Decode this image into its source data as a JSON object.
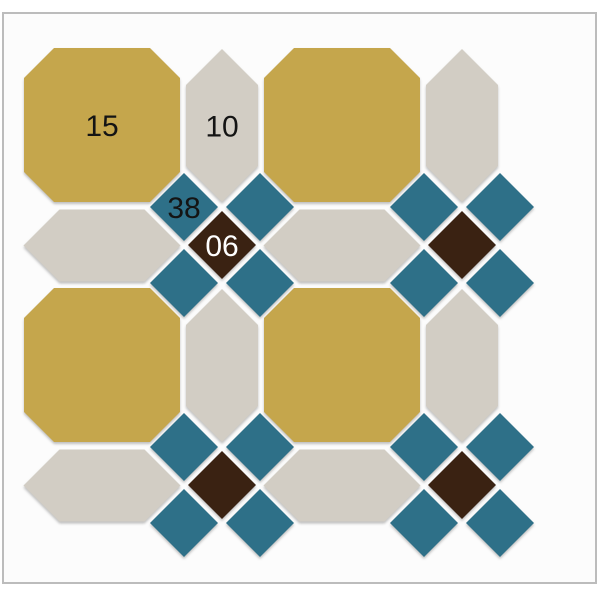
{
  "canvas": {
    "width": 600,
    "height": 600,
    "frame": {
      "x": 3,
      "y": 13,
      "w": 593,
      "h": 570
    }
  },
  "palette": {
    "octagon_fill": "#C5A64C",
    "picket_fill": "#D2CDC4",
    "square_fill": "#2E7088",
    "dot_fill": "#3A2212",
    "label_dark": "#141414",
    "label_light": "#FFFFFF",
    "panel_fill": "#FCFCFC",
    "panel_border": "#BCBCBC",
    "page_bg": "#FFFFFF"
  },
  "legend": {
    "octagon_code": "15",
    "picket_code": "10",
    "square_code": "38",
    "dot_code": "06"
  },
  "pattern": {
    "unit": 240,
    "octagon_shape": {
      "w": 156,
      "h": 154,
      "corner": 30
    },
    "picket_v_shape": {
      "w": 72,
      "len": 153,
      "tip": 36
    },
    "picket_h_shape": {
      "w": 72,
      "len": 157,
      "tip": 36
    },
    "diamond_shape": {
      "half": 34,
      "offset": 38
    },
    "octagons": [
      {
        "cx": 102,
        "cy": 125,
        "label": "15"
      },
      {
        "cx": 342,
        "cy": 125
      },
      {
        "cx": 102,
        "cy": 365
      },
      {
        "cx": 342,
        "cy": 365
      }
    ],
    "pickets_v": [
      {
        "cx": 222,
        "cy": 125.5,
        "label": "10"
      },
      {
        "cx": 462,
        "cy": 125.5
      },
      {
        "cx": 222,
        "cy": 365.5
      },
      {
        "cx": 462,
        "cy": 365.5
      }
    ],
    "pickets_h": [
      {
        "cx": 102,
        "cy": 245.5
      },
      {
        "cx": 342,
        "cy": 245.5
      },
      {
        "cx": 102,
        "cy": 485.5
      },
      {
        "cx": 342,
        "cy": 485.5
      }
    ],
    "clusters": [
      {
        "cx": 222,
        "cy": 245,
        "square_label": "38",
        "dot_label": "06"
      },
      {
        "cx": 462,
        "cy": 245
      },
      {
        "cx": 222,
        "cy": 485
      },
      {
        "cx": 462,
        "cy": 485
      }
    ]
  }
}
